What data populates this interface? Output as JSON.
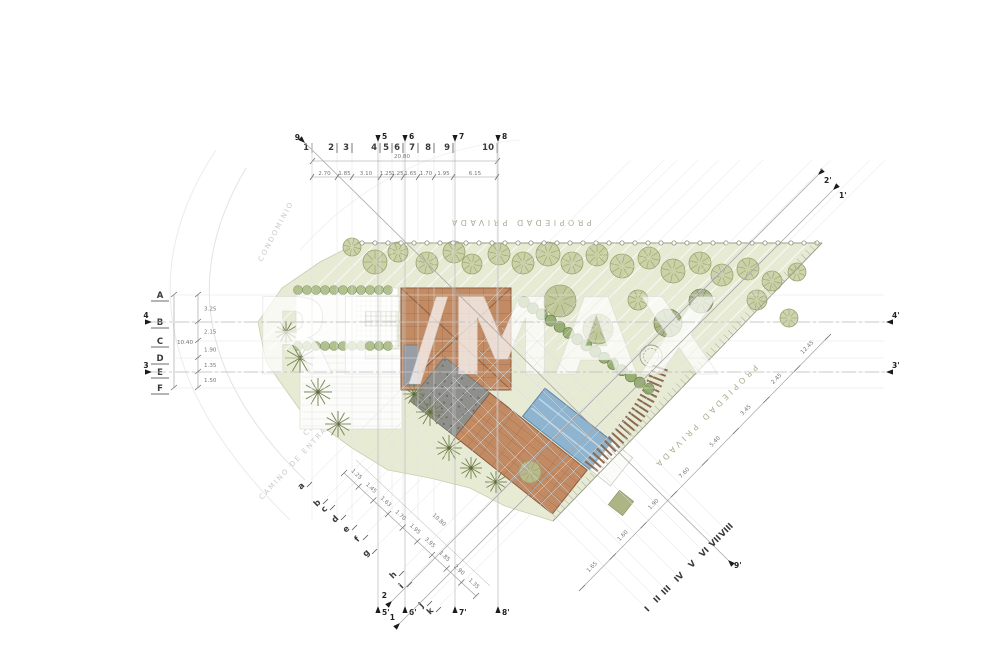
{
  "watermark": {
    "text": "RE/MAX"
  },
  "boundary": {
    "top_label": "PROPIEDAD PRIVADA",
    "right_label": "PROPIEDAD PRIVADA"
  },
  "streets": {
    "arc_label": "CONDOMINIO",
    "entry_label": "CAMINO DE ENTRADA",
    "cross_label": "CALLE CRUZ"
  },
  "grid": {
    "columns": [
      {
        "l": "1",
        "x": 310
      },
      {
        "l": "2",
        "x": 335
      },
      {
        "l": "3",
        "x": 350
      },
      {
        "l": "4",
        "x": 378
      },
      {
        "l": "5",
        "x": 390
      },
      {
        "l": "6",
        "x": 401
      },
      {
        "l": "7",
        "x": 416
      },
      {
        "l": "8",
        "x": 432
      },
      {
        "l": "9",
        "x": 451
      },
      {
        "l": "10",
        "x": 495
      }
    ],
    "col_dims": [
      "2.70",
      "1.85",
      "3.10",
      "1.25",
      "1.25",
      "1.65",
      "1.70",
      "1.95",
      "6.15"
    ],
    "col_total": "20.80",
    "rows": [
      {
        "l": "A",
        "y": 295
      },
      {
        "l": "B",
        "y": 322
      },
      {
        "l": "C",
        "y": 341
      },
      {
        "l": "D",
        "y": 358
      },
      {
        "l": "E",
        "y": 372
      },
      {
        "l": "F",
        "y": 388
      }
    ],
    "row_dims": [
      "3.25",
      "2.15",
      "1.90",
      "1.35",
      "1.50"
    ],
    "row_total": "10.40",
    "sections_v": [
      {
        "l": "5",
        "x": 378
      },
      {
        "l": "6",
        "x": 405
      },
      {
        "l": "7",
        "x": 455
      },
      {
        "l": "8",
        "x": 498
      }
    ],
    "sections_h": [
      {
        "l": "4",
        "y": 322
      },
      {
        "l": "3",
        "y": 372
      }
    ],
    "diag_sections": [
      {
        "l1": "9",
        "l2": "9'",
        "x1": 305,
        "y1": 143,
        "x2": 728,
        "y2": 560
      },
      {
        "l1": "2",
        "l2": "2'",
        "x1": 392,
        "y1": 601,
        "x2": 818,
        "y2": 175
      },
      {
        "l1": "1",
        "l2": "1'",
        "x1": 400,
        "y1": 623,
        "x2": 833,
        "y2": 190
      }
    ],
    "diag_letters": [
      {
        "l": "a",
        "x": 303,
        "y": 488
      },
      {
        "l": "b",
        "x": 319,
        "y": 505
      },
      {
        "l": "c",
        "x": 326,
        "y": 511
      },
      {
        "l": "d",
        "x": 337,
        "y": 521
      },
      {
        "l": "e",
        "x": 348,
        "y": 531
      },
      {
        "l": "f",
        "x": 359,
        "y": 541
      },
      {
        "l": "g",
        "x": 368,
        "y": 555
      },
      {
        "l": "h",
        "x": 395,
        "y": 577
      },
      {
        "l": "i",
        "x": 403,
        "y": 588
      },
      {
        "l": "j",
        "x": 423,
        "y": 607
      },
      {
        "l": "k",
        "x": 432,
        "y": 613
      }
    ],
    "diag_romans": [
      {
        "l": "I",
        "x": 649,
        "y": 611
      },
      {
        "l": "II",
        "x": 659,
        "y": 601
      },
      {
        "l": "III",
        "x": 668,
        "y": 592
      },
      {
        "l": "IV",
        "x": 681,
        "y": 579
      },
      {
        "l": "V",
        "x": 694,
        "y": 566
      },
      {
        "l": "VI",
        "x": 706,
        "y": 554
      },
      {
        "l": "VII",
        "x": 717,
        "y": 543
      },
      {
        "l": "VIII",
        "x": 728,
        "y": 532
      }
    ],
    "chain_left": {
      "x1": 344,
      "y1": 473,
      "x2": 476,
      "y2": 596,
      "dims": [
        "1.25",
        "1.45",
        "1.63",
        "1.70",
        "1.95",
        "3.95",
        "1.85",
        "2.90",
        "1.35"
      ],
      "total": "10.80"
    },
    "chain_right": {
      "x1": 582,
      "y1": 588,
      "x2": 828,
      "y2": 337,
      "dims": [
        "1.65",
        "1.60",
        "1.90",
        "7.60",
        "5.40",
        "3.45",
        "2.45",
        "12.45"
      ]
    }
  },
  "landscape": {
    "trees": [
      [
        352,
        247,
        9,
        "t"
      ],
      [
        375,
        262,
        12,
        "t"
      ],
      [
        398,
        252,
        10,
        "t"
      ],
      [
        427,
        263,
        11,
        "t"
      ],
      [
        454,
        252,
        11,
        "t"
      ],
      [
        472,
        264,
        10,
        "t"
      ],
      [
        499,
        254,
        11,
        "t"
      ],
      [
        523,
        263,
        11,
        "t"
      ],
      [
        548,
        254,
        12,
        "t"
      ],
      [
        572,
        263,
        11,
        "t"
      ],
      [
        597,
        255,
        11,
        "t"
      ],
      [
        622,
        266,
        12,
        "t"
      ],
      [
        649,
        258,
        11,
        "t"
      ],
      [
        673,
        271,
        12,
        "t"
      ],
      [
        700,
        263,
        11,
        "t"
      ],
      [
        722,
        275,
        11,
        "t"
      ],
      [
        748,
        269,
        11,
        "t"
      ],
      [
        772,
        281,
        10,
        "t"
      ],
      [
        797,
        272,
        9,
        "t"
      ],
      [
        560,
        301,
        16,
        "b"
      ],
      [
        598,
        329,
        15,
        "b"
      ],
      [
        668,
        323,
        14,
        "m"
      ],
      [
        701,
        301,
        12,
        "m"
      ],
      [
        638,
        300,
        10,
        "t"
      ],
      [
        757,
        300,
        10,
        "t"
      ],
      [
        789,
        318,
        9,
        "t"
      ],
      [
        530,
        472,
        11,
        "b"
      ]
    ],
    "palms": [
      [
        300,
        358,
        15
      ],
      [
        318,
        392,
        14
      ],
      [
        338,
        424,
        13
      ],
      [
        286,
        332,
        11
      ],
      [
        430,
        412,
        14
      ],
      [
        449,
        448,
        13
      ],
      [
        471,
        468,
        11
      ],
      [
        414,
        394,
        11
      ],
      [
        496,
        482,
        11
      ]
    ]
  },
  "colors": {
    "site_green": "#e8ebd4",
    "roof_terracotta": "#c28b64",
    "roof_line": "#a5714e",
    "pool_blue": "#8fb4cf",
    "pool_edge": "#5d87a8",
    "terrace_gray": "#8f8f8c",
    "tree_olive": "#c6cc9d",
    "hedge_green": "#8fa769",
    "tie_brown": "#8c6a52"
  }
}
